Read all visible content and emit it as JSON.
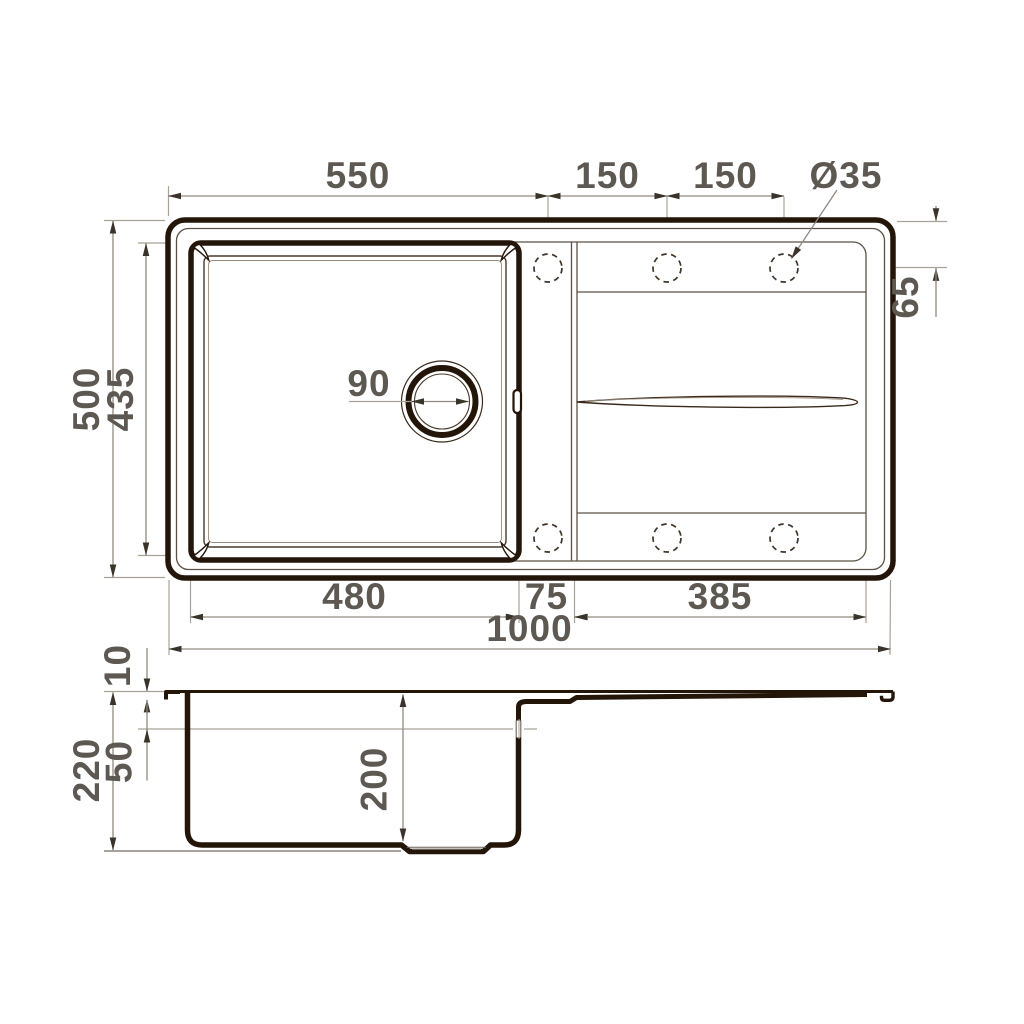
{
  "title": "Kitchen sink technical dimension drawing",
  "views": {
    "plan": "top view (sink with single bowl, drainboard, faucet holes)",
    "section": "side section view (bowl profile with drainboard)"
  },
  "units": "mm",
  "colors": {
    "ink": "#241509",
    "medium_line": "#3a2a1c",
    "thin_line": "#5c5144",
    "dimension_line": "#908a81",
    "extension_line": "#a8a299",
    "arrow": "#3a332a",
    "text": "#5e5852",
    "background": "#ffffff"
  },
  "dimensions": {
    "faucet_offset_x": "550",
    "faucet_pitch_1": "150",
    "faucet_pitch_2": "150",
    "faucet_hole_dia": "Ø35",
    "overall_depth": "500",
    "bowl_inner_depth_plan": "435",
    "faucet_edge_offset": "65",
    "drain_dia": "90",
    "bowl_width_bottom": "480",
    "web_width": "75",
    "drainboard_width": "385",
    "overall_length": "1000",
    "rim_height": "10",
    "overflow_offset": "50",
    "overall_height": "220",
    "bowl_depth": "200"
  }
}
